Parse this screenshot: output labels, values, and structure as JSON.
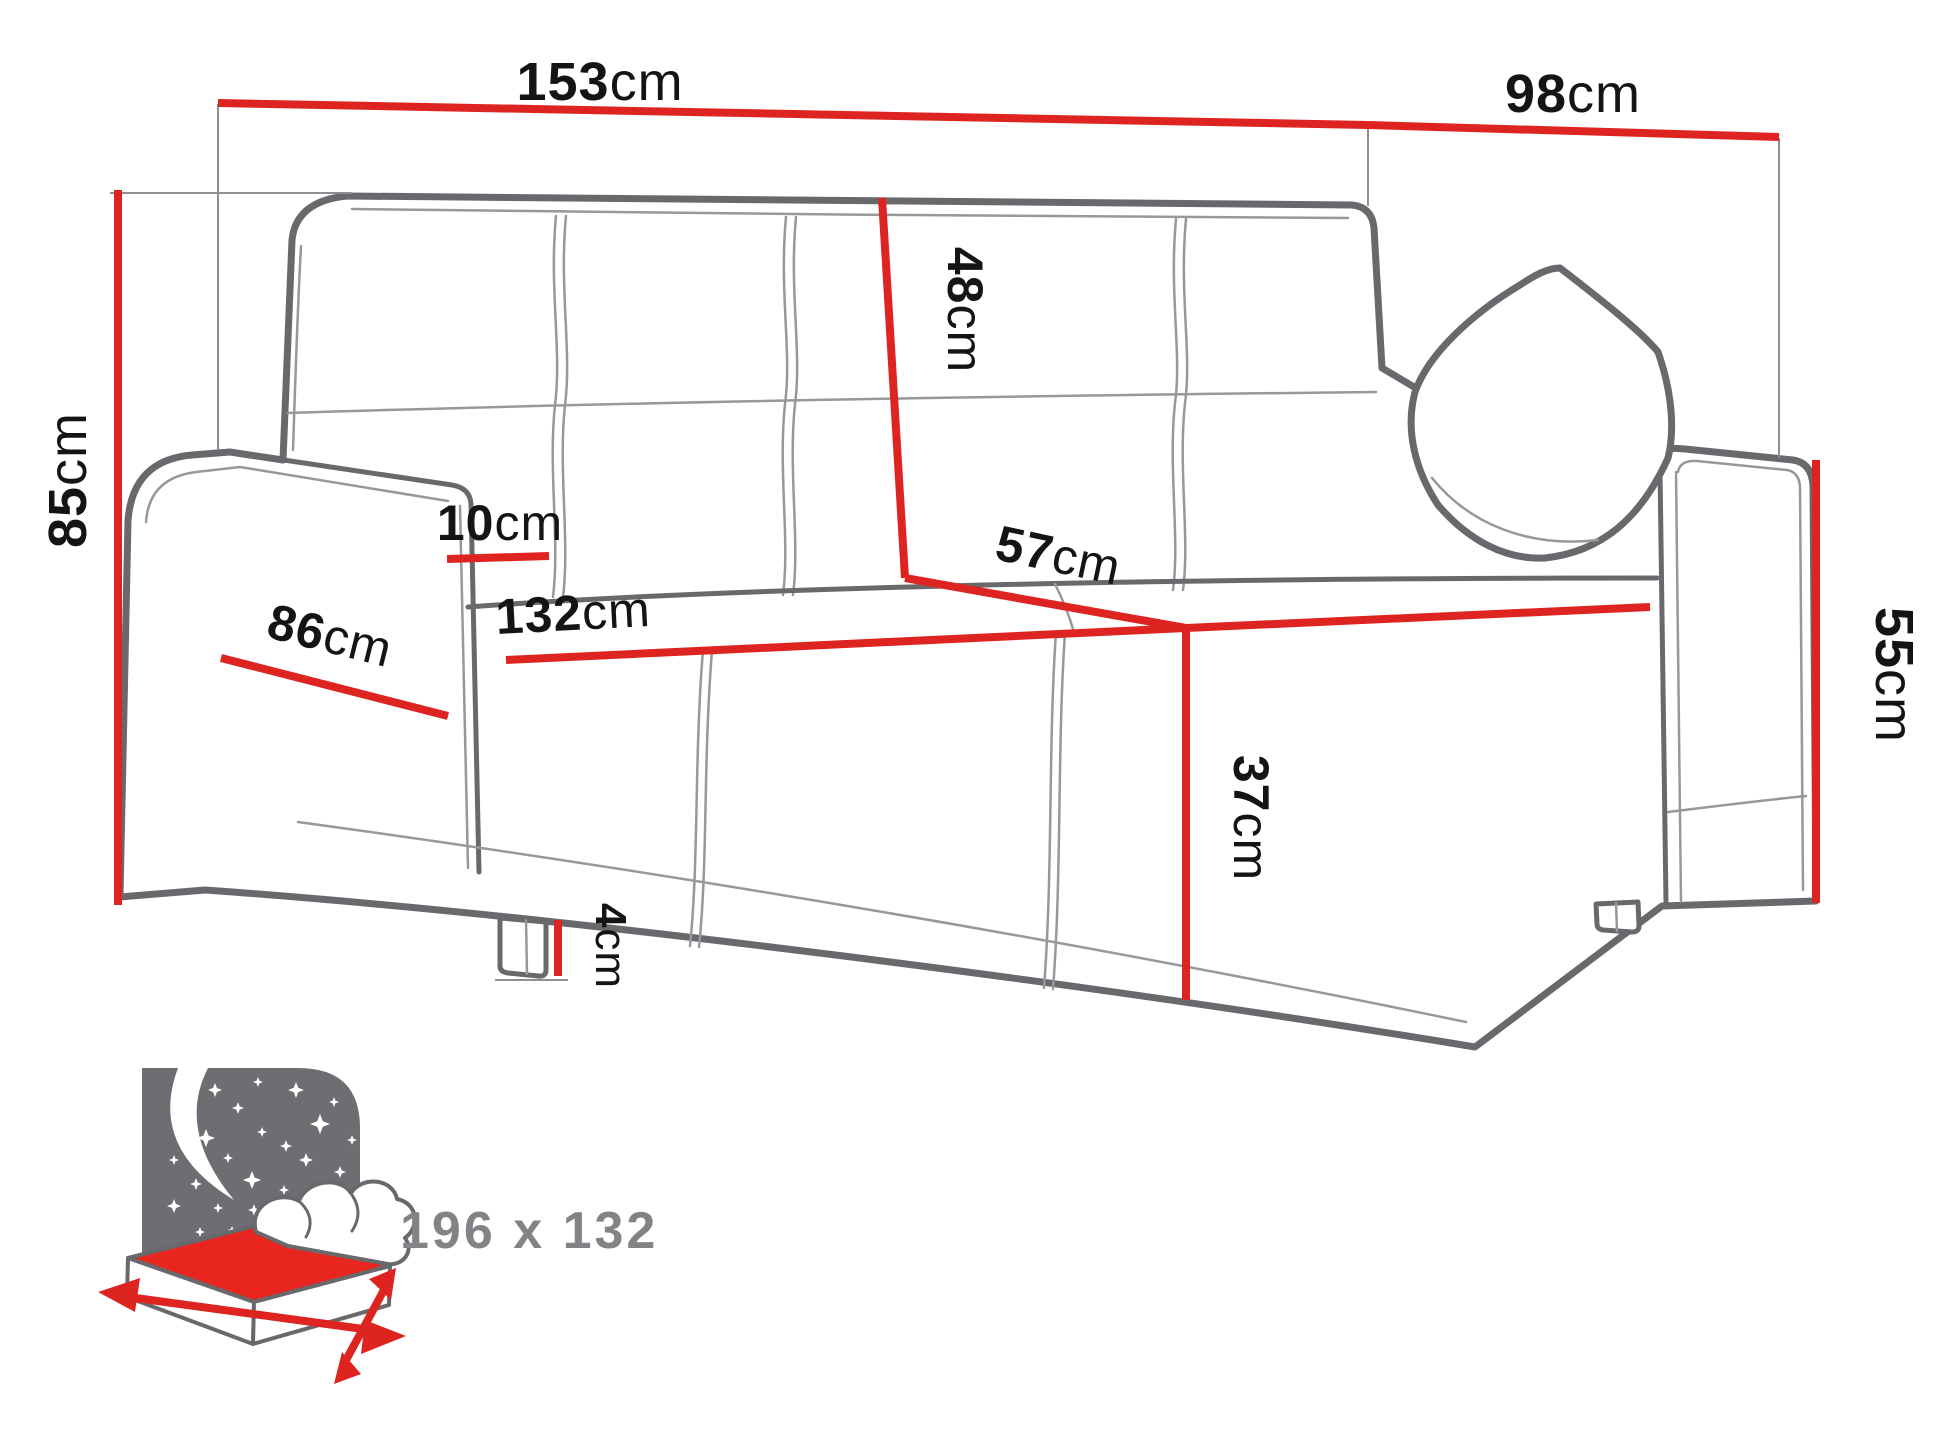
{
  "figure": {
    "type": "furniture dimension diagram",
    "subject": "sofa bed technical sketch"
  },
  "dimensions": {
    "total_width": {
      "value": "153",
      "unit": "cm"
    },
    "total_depth": {
      "value": "98",
      "unit": "cm"
    },
    "total_height": {
      "value": "85",
      "unit": "cm"
    },
    "backrest_height": {
      "value": "48",
      "unit": "cm"
    },
    "armrest_width": {
      "value": "10",
      "unit": "cm"
    },
    "armrest_depth": {
      "value": "86",
      "unit": "cm"
    },
    "seat_width": {
      "value": "132",
      "unit": "cm"
    },
    "seat_depth": {
      "value": "57",
      "unit": "cm"
    },
    "seat_height": {
      "value": "37",
      "unit": "cm"
    },
    "armrest_height": {
      "value": "55",
      "unit": "cm"
    },
    "leg_height": {
      "value": "4",
      "unit": "cm"
    }
  },
  "sleeping_area": {
    "size_label": "196 x 132"
  },
  "colors": {
    "dimension_line": "#de2420",
    "sketch_outline": "#68696c",
    "seam": "#97989b",
    "label_text": "#141414",
    "icon_panel": "#6d6e71",
    "icon_red": "#e8251f",
    "icon_text": "#828386",
    "background": "#ffffff"
  }
}
